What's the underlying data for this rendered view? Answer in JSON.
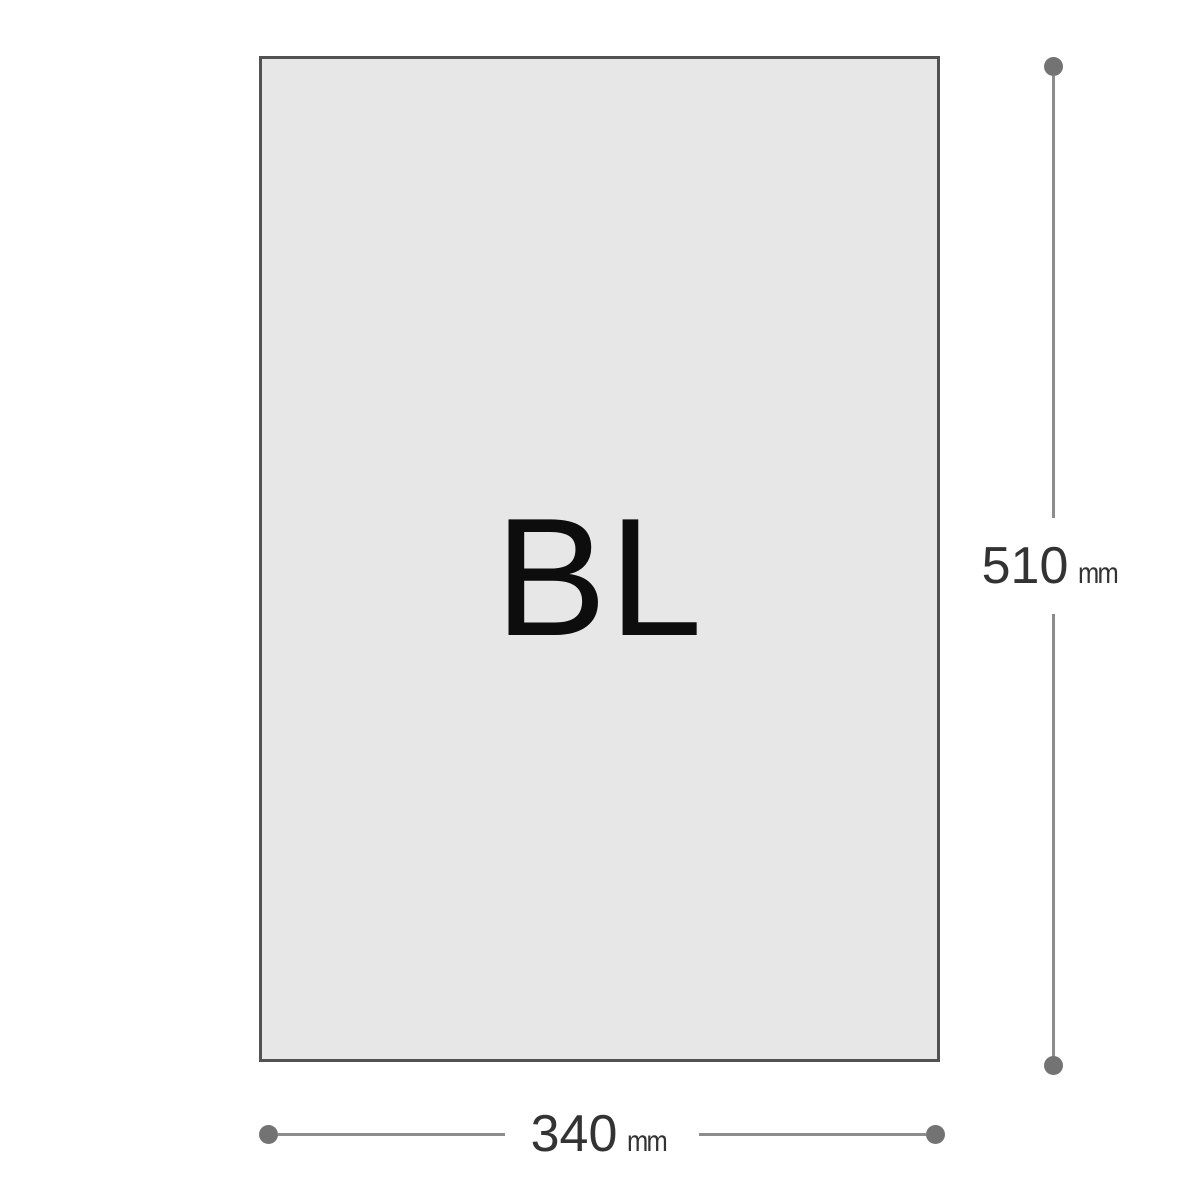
{
  "diagram": {
    "paper": {
      "label": "BL"
    },
    "height_dimension": {
      "value": "510",
      "unit": "mm"
    },
    "width_dimension": {
      "value": "340",
      "unit": "mm"
    },
    "colors": {
      "background": "#ffffff",
      "paper_fill": "#e7e7e7",
      "paper_border": "#525254",
      "dimension_line": "#8c8c8c",
      "dimension_dot": "#737373",
      "dimension_text": "#333333",
      "label_text": "#0d0d0d"
    }
  }
}
